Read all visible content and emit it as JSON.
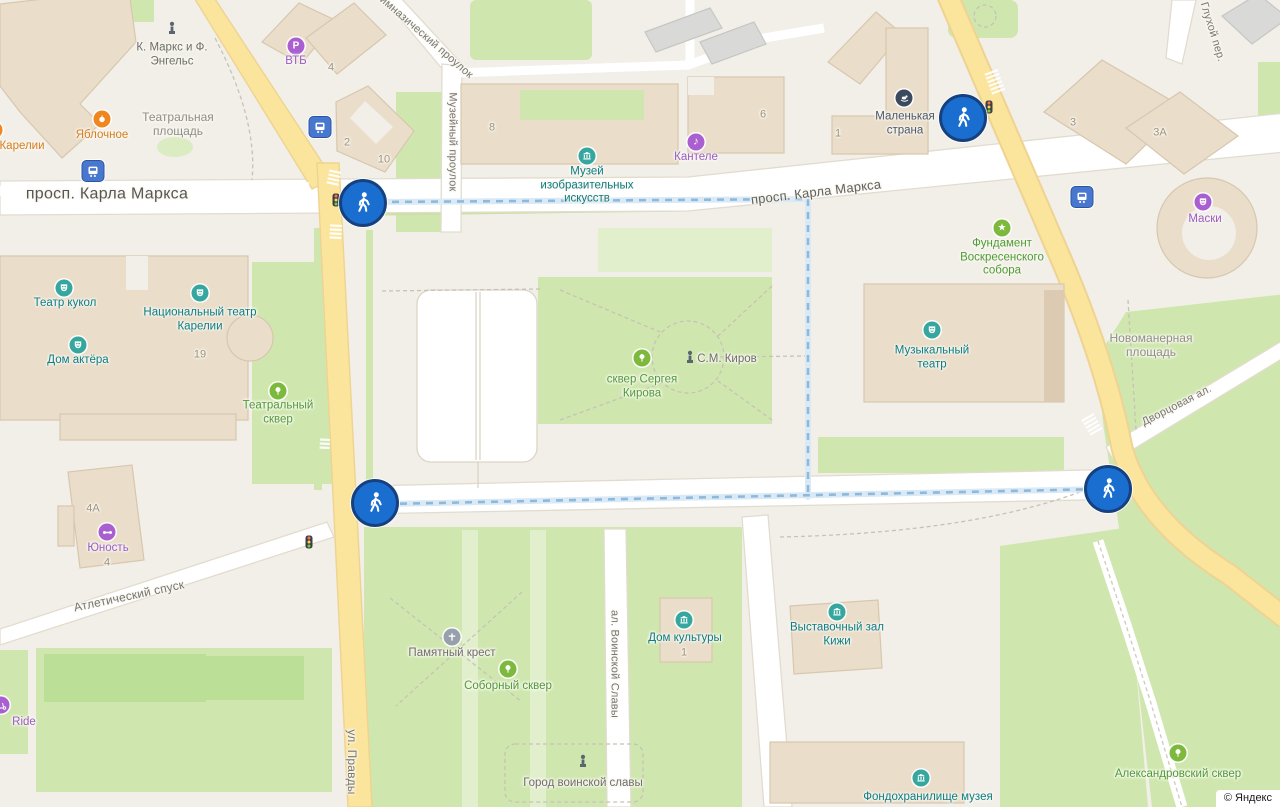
{
  "attribution": {
    "text": "© Яндекс"
  },
  "streets": {
    "karla_marksa": "просп. Карла Маркса",
    "gimnazichesky": "Гимназический проулок",
    "muzeiny": "Музейный проулок",
    "glukhoy": "Глухой пер.",
    "dvortsovaya": "Дворцовая ал.",
    "novomanernaya": "Новоманерная площадь",
    "teatralnaya_pl": "Театральная площадь",
    "atletichesky": "Атлетический спуск",
    "pravdy": "ул. Правды",
    "voinskoy_slavy": "ал. Воинской Славы"
  },
  "pois": {
    "marks_engels": "К. Маркс и Ф. Энгельс",
    "yablochnoe": "Яблочное",
    "karelii": "Карелии",
    "vtb": "ВТБ",
    "muzey_izo": "Музей изобразительных искусств",
    "kantele": "Кантеле",
    "malenkaya_strana": "Маленькая страна",
    "maski": "Маски",
    "fundament": "Фундамент Воскресенского собора",
    "teatr_kukol": "Театр кукол",
    "nat_teatr": "Национальный театр Карелии",
    "dom_aktera": "Дом актёра",
    "teatralny_skver": "Театральный сквер",
    "skver_kirova": "сквер Сергея Кирова",
    "kirov": "С.М. Киров",
    "muz_teatr": "Музыкальный театр",
    "yunost": "Юность",
    "ride": "Ride",
    "pamyatny_krest": "Памятный крест",
    "soborny_skver": "Соборный сквер",
    "dom_kultury": "Дом культуры",
    "vystavochny": "Выставочный зал Кижи",
    "gorod_slavy": "Город воинской славы",
    "fond": "Фондохранилище музея",
    "aleksandrovsky": "Александровский сквер"
  },
  "numbers": {
    "n2": "2",
    "n10": "10",
    "n8": "8",
    "n6": "6",
    "n1": "1",
    "n4": "4",
    "n19": "19",
    "n3": "3",
    "n3a": "3А",
    "n4a": "4А",
    "n4y": "4",
    "ndk1": "1"
  },
  "icons": {
    "star_glyph": "★",
    "note_glyph": "♪",
    "parking_glyph": "P",
    "names": [
      "pedestrian-crossing",
      "traffic-light",
      "tram-stop",
      "museum",
      "theater-mask",
      "park-tree",
      "monument-statue",
      "memorial-cross",
      "star",
      "music-note",
      "parking",
      "kids-center",
      "sports-center",
      "cafe",
      "scooter-rental"
    ]
  },
  "palette": {
    "background": "#f2efe8",
    "road_fill": "#ffffff",
    "road_border": "#e2dcce",
    "road_yellow": "#fbe49c",
    "road_yellow_border": "#eed392",
    "park_green": "#cfe7ae",
    "park_green_dark": "#bcdf98",
    "park_green_light": "#e2efcd",
    "building_fill": "#eaddc9",
    "building_border": "#d7c7af",
    "building_gray": "#d9d9d7",
    "route_band": "#d9eaf6",
    "route_dash": "#8fb9da",
    "pedestrian_blue": "#1a6ed0",
    "pedestrian_ring": "#16417e",
    "poi_teal": "#0e7c80",
    "poi_teal_icon": "#35a79f",
    "poi_green": "#4f9b35",
    "poi_green_icon": "#7cb93c",
    "poi_purple": "#9a5cc4",
    "poi_orange": "#d87e1f",
    "poi_dark": "#4c5666",
    "tram_blue": "#4877cf"
  }
}
